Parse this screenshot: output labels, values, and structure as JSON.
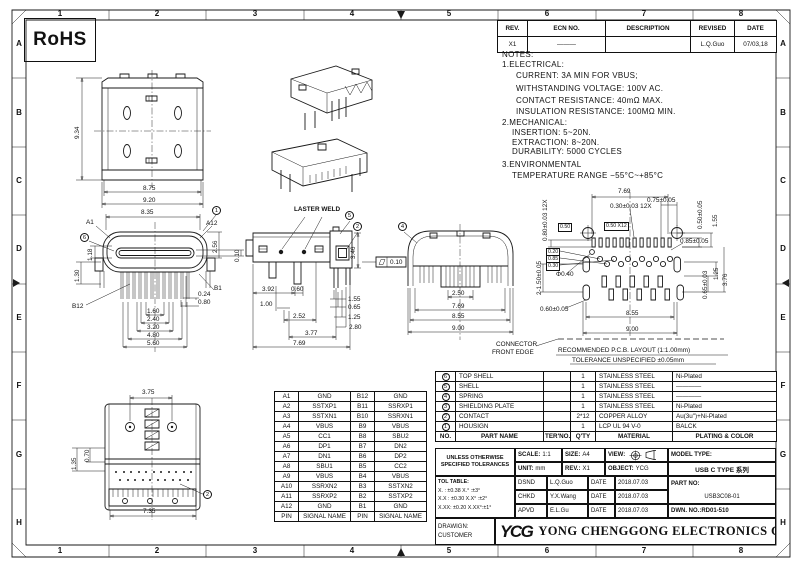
{
  "frame": {
    "cols": [
      "1",
      "2",
      "3",
      "4",
      "5",
      "6",
      "7",
      "8"
    ],
    "rows": [
      "A",
      "B",
      "C",
      "D",
      "E",
      "F",
      "G",
      "H"
    ]
  },
  "rohs_label": "RoHS",
  "revision": {
    "headers": [
      "REV.",
      "ECN NO.",
      "DESCRIPTION",
      "REVISED",
      "DATE"
    ],
    "row": {
      "rev": "X1",
      "ecn": "———",
      "desc": "",
      "revised": "L.Q.Guo",
      "date": "07/03,18"
    }
  },
  "notes": {
    "title": "NOTES:",
    "s1": "1.ELECTRICAL:",
    "s1_lines": [
      "CURRENT: 3A MIN FOR VBUS;",
      "WITHSTANDING VOLTAGE: 100V AC.",
      "CONTACT RESISTANCE: 40mΩ MAX.",
      "INSULATION RESISTANCE: 100MΩ MIN."
    ],
    "s2": "2.MECHANICAL:",
    "s2_lines": [
      "INSERTION: 5~20N.",
      "EXTRACTION: 8~20N.",
      "DURABILITY: 5000 CYCLES"
    ],
    "s3": "3.ENVIRONMENTAL",
    "s3_lines": [
      "TEMPERATURE RANGE −55°C~+85°C"
    ]
  },
  "views": {
    "top": {
      "d934": "9.34",
      "d875": "8.75",
      "d920": "9.20"
    },
    "front": {
      "a1": "A1",
      "a12": "A12",
      "b1": "B1",
      "b12": "B12",
      "c_left": "6",
      "c_right": "1",
      "d835": "8.35",
      "d118": "1.18",
      "d130": "1.30",
      "d256": "2.56",
      "d010": "0.10",
      "d024": "0.24",
      "d080": "0.80",
      "d160": "1.60",
      "d240": "2.40",
      "d320": "3.20",
      "d480": "4.80",
      "d560": "5.60"
    },
    "side": {
      "weld": "LASTER WELD",
      "c1": "5",
      "c2": "2",
      "d346": "3.46",
      "d392": "3.92",
      "d060": "0.60",
      "d100": "1.00",
      "d252": "2.52",
      "d377": "3.77",
      "d769": "7.69",
      "d155": "1.55",
      "d065": "0.65",
      "d125": "1.25",
      "d280": "2.80",
      "flatness": "0.10"
    },
    "rear": {
      "c1": "4",
      "d250": "2.50",
      "d769": "7.69",
      "d855": "8.55",
      "d900": "9.00"
    },
    "pcb": {
      "d769": "7.69",
      "d075": "0.75±0.05",
      "d030": "0.30±0.03 12X",
      "d080": "0.80±0.03 12X",
      "b050a": "0.50",
      "b050b": "0.50 X12",
      "d050": "0.50±0.05",
      "d155": "1.55",
      "d085": "0.85±0.05",
      "b020": "0.20",
      "b085": "0.85",
      "b030": "0.30",
      "d150": "2-1.50±0.05",
      "d040": "Φ0.40",
      "d060": "0.60±0.05",
      "d376": "3.76",
      "d125": "1.25",
      "d065": "0.65±0.03",
      "d855": "8.55",
      "d900": "9.00",
      "edge1": "CONNECTOR",
      "edge2": "FRONT EDGE",
      "note1": "RECOMMENDED  P.C.B. LAYOUT (1:1.00mm)",
      "note2": "TOLERANCE UNSPECIFIED ±0.05mm"
    },
    "bottom": {
      "d375": "3.75",
      "d135": "1.35",
      "d070": "0.70",
      "d735": "7.35",
      "c1": "2"
    }
  },
  "pin_table": {
    "rows": [
      [
        "A1",
        "GND",
        "B12",
        "GND"
      ],
      [
        "A2",
        "SSTXP1",
        "B11",
        "SSRXP1"
      ],
      [
        "A3",
        "SSTXN1",
        "B10",
        "SSRXN1"
      ],
      [
        "A4",
        "VBUS",
        "B9",
        "VBUS"
      ],
      [
        "A5",
        "CC1",
        "B8",
        "SBU2"
      ],
      [
        "A6",
        "DP1",
        "B7",
        "DN2"
      ],
      [
        "A7",
        "DN1",
        "B6",
        "DP2"
      ],
      [
        "A8",
        "SBU1",
        "B5",
        "CC2"
      ],
      [
        "A9",
        "VBUS",
        "B4",
        "VBUS"
      ],
      [
        "A10",
        "SSRXN2",
        "B3",
        "SSTXN2"
      ],
      [
        "A11",
        "SSRXP2",
        "B2",
        "SSTXP2"
      ],
      [
        "A12",
        "GND",
        "B1",
        "GND"
      ]
    ],
    "footer": [
      "PIN",
      "SIGNAL NAME",
      "PIN",
      "SIGNAL NAME"
    ]
  },
  "bom": {
    "headers": [
      "NO.",
      "PART NAME",
      "TER'NO.",
      "Q'TY",
      "MATERIAL",
      "PLATING & COLOR"
    ],
    "rows": [
      [
        "6",
        "TOP SHELL",
        "",
        "1",
        "STAINLESS STEEL",
        "Ni-Plated"
      ],
      [
        "5",
        "SHELL",
        "",
        "1",
        "STAINLESS STEEL",
        "————"
      ],
      [
        "4",
        "SPRING",
        "",
        "1",
        "STAINLESS STEEL",
        "————"
      ],
      [
        "3",
        "SHIELDING PLATE",
        "",
        "1",
        "STAINLESS STEEL",
        "Ni-Plated"
      ],
      [
        "2",
        "CONTACT",
        "",
        "2*12",
        "COPPER ALLOY",
        "Au(3u\")+Ni-Plated"
      ],
      [
        "1",
        "HOUSIGN",
        "",
        "1",
        "LCP UL 94 V-0",
        "BALCK"
      ]
    ]
  },
  "title_block": {
    "tol_note1": "UNLESS OTHERWISE",
    "tol_note2": "SPECIFIED TOLERANCES",
    "scale_label": "SCALE:",
    "scale": "1:1",
    "size_label": "SIZE:",
    "size": "A4",
    "view_label": "VIEW:",
    "model_label": "MODEL TYPE:",
    "model": "USB C TYPE 系列",
    "unit_label": "UNIT:",
    "unit": "mm",
    "rev_label": "REV.:",
    "rev": "X1",
    "object_label": "OBJECT:",
    "object": "YCG",
    "tol_title": "TOL TABLE:",
    "tol_rows": [
      "X.  : ±0.38     X.°  :±3°",
      "X.X : ±0.30    X.X° :±2°",
      "X.XX: ±0.20    X.XX°:±1°"
    ],
    "dsnd_label": "DSND",
    "dsnd": "L.Q.Guo",
    "chkd_label": "CHKD",
    "chkd": "Y.X.Wang",
    "apvd_label": "APVD",
    "apvd": "E.L.Gu",
    "date_label": "DATE",
    "date": "2018.07.03",
    "part_no_label": "PART NO:",
    "part_no": "USB3C08-01",
    "dwn_no": "DWN. NO.:RD01-510",
    "drawing_label": "DRAWIGN:",
    "customer": "CUSTOMER",
    "logo": "YCG",
    "company": "YONG CHENGGONG ELECTRONICS CO. , LTD."
  }
}
